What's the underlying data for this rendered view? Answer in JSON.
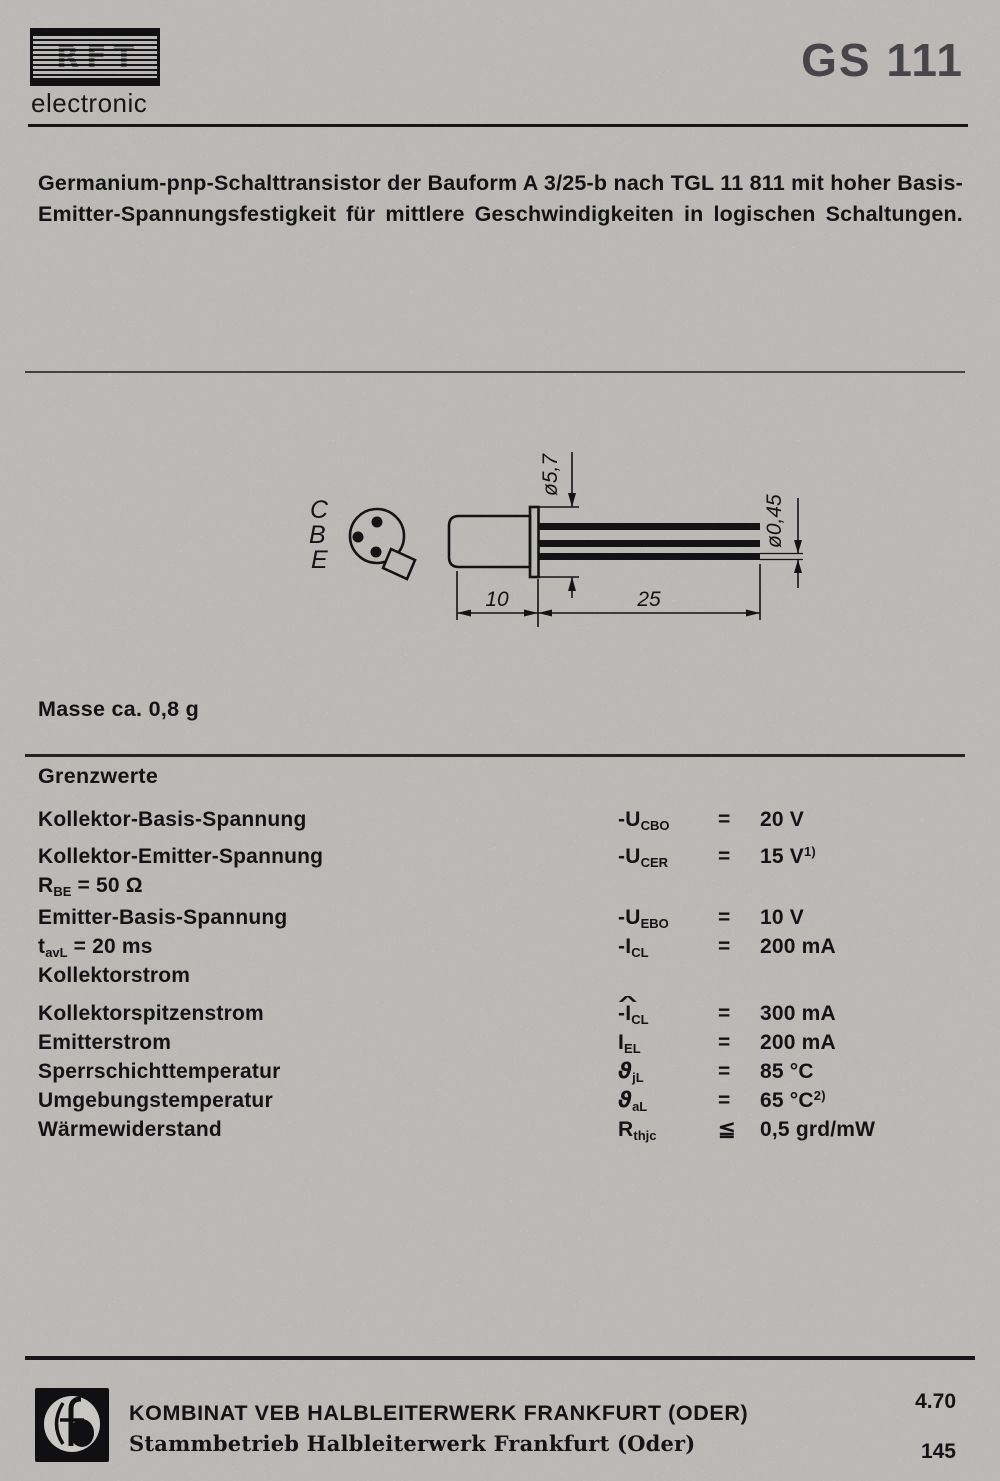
{
  "brand": {
    "logo_text": "RFT",
    "tagline": "electronic"
  },
  "product_code": "GS 111",
  "description": "Germanium-pnp-Schalttransistor der Bauform A 3/25-b nach TGL 11 811 mit hoher Basis-Emitter-Spannungsfestigkeit für mittlere Geschwindigkeiten in logischen Schaltungen.",
  "diagram": {
    "pin_labels": [
      "C",
      "B",
      "E"
    ],
    "dim_body_diameter": "ø5,7",
    "dim_lead_diameter": "ø0,45",
    "dim_body_length": "10",
    "dim_lead_length": "25"
  },
  "mass_note": "Masse ca. 0,8 g",
  "limits": {
    "heading": "Grenzwerte",
    "rows": [
      {
        "label": "Kollektor-Basis-Spannung",
        "sym_pre": "-U",
        "sym_sub": "CBO",
        "rel": "=",
        "val": "20 V"
      },
      {
        "label": "Kollektor-Emitter-Spannung",
        "sym_pre": "-U",
        "sym_sub": "CER",
        "rel": "=",
        "val": "15 V",
        "val_sup": "1)"
      },
      {
        "label_pre": "R",
        "label_sub": "BE",
        "label_post": " = 50 Ω"
      },
      {
        "label": "Emitter-Basis-Spannung",
        "sym_pre": "-U",
        "sym_sub": "EBO",
        "rel": "=",
        "val": "10 V"
      },
      {
        "label_pre": "t",
        "label_sub": "avL",
        "label_post": " = 20 ms",
        "sym_pre": "-I",
        "sym_sub": "CL",
        "rel": "=",
        "val": "200 mA"
      },
      {
        "label": "Kollektorstrom"
      },
      {
        "label": "Kollektorspitzenstrom",
        "sym_pre": "-",
        "sym_base": "I",
        "sym_hat": "^",
        "sym_sub": "CL",
        "rel": "=",
        "val": "300 mA"
      },
      {
        "label": "Emitterstrom",
        "sym_pre": "I",
        "sym_sub": "EL",
        "rel": "=",
        "val": "200 mA"
      },
      {
        "label": "Sperrschichttemperatur",
        "sym_pre": "ϑ",
        "sym_sub": "jL",
        "rel": "=",
        "val": "85 °C"
      },
      {
        "label": "Umgebungstemperatur",
        "sym_pre": "ϑ",
        "sym_sub": "aL",
        "rel": "=",
        "val": "65 °C",
        "val_sup": "2)"
      },
      {
        "label": "Wärmewiderstand",
        "sym_pre": "R",
        "sym_sub": "thjc",
        "rel": "≦",
        "val": "0,5 grd/mW"
      }
    ]
  },
  "footer": {
    "company_line1": "KOMBINAT VEB HALBLEITERWERK FRANKFURT (ODER)",
    "company_line2": "Stammbetrieb Halbleiterwerk Frankfurt (Oder)",
    "date_code": "4.70",
    "page_number": "145"
  },
  "colors": {
    "paper": "#d7d6d2",
    "ink": "#17171a",
    "title_gray": "#515055"
  }
}
